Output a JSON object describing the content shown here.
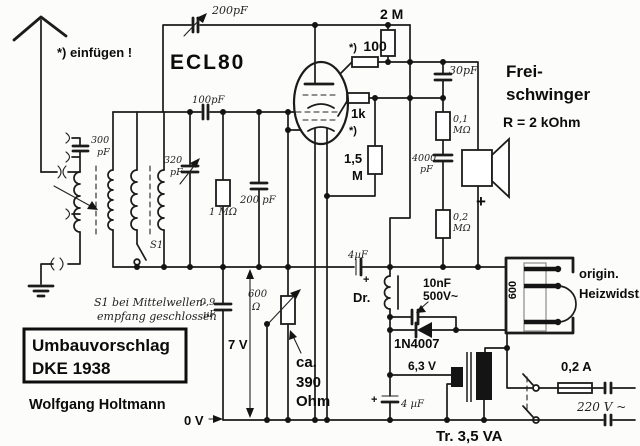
{
  "colors": {
    "ink": "#1b1b1b",
    "paper": "#fcfcfa"
  },
  "labels": {
    "ecl80": "ECL80",
    "insert_note": "*) einfügen !",
    "c200_top": "200pF",
    "r_2m": "2 M",
    "r100_prefix": "*)",
    "r100_value": "100",
    "c30": "30pF",
    "frei1": "Frei-",
    "frei2": "schwinger",
    "frei_r": "R = 2 kOhm",
    "r01m_v": "0,1",
    "r01m_u": "MΩ",
    "c4000_v": "4000",
    "c4000_u": "pF",
    "r02m_v": "0,2",
    "r02m_u": "MΩ",
    "plus": "+",
    "r1k": "1k",
    "r1k_note": "*)",
    "r15m_v": "1,5",
    "r15m_u": "M",
    "c100": "100pF",
    "c200_mid": "200 pF",
    "r1m": "1 MΩ",
    "c300_v": "300",
    "c300_u": "pF",
    "c320_v": "320",
    "c320_u": "pF",
    "s1": "S1",
    "s1_note1": "S1 bei Mittelwellen-",
    "s1_note2": "empfang geschlossen",
    "c09_v": "0,9",
    "c09_u": "µF",
    "v7": "7 V",
    "r600_v": "600",
    "r600_u": "Ω",
    "ca390_1": "ca.",
    "ca390_2": "390",
    "ca390_3": "Ohm",
    "c4uf_bus": "4µF",
    "dr": "Dr.",
    "c10nf_1": "10nF",
    "c10nf_2": "500V~",
    "d1n4007": "1N4007",
    "heiz600": "600",
    "heiz_note1": "origin.",
    "heiz_note2": "Heizwidst.",
    "v63": "6,3 V",
    "c4uf_psu": "4 µF",
    "tr": "Tr.  3,5 VA",
    "a02": "0,2 A",
    "v220": "220 V ~",
    "v0": "0 V",
    "box_line1": "Umbauvorschlag",
    "box_line2": "DKE 1938",
    "author": "Wolfgang Holtmann"
  }
}
